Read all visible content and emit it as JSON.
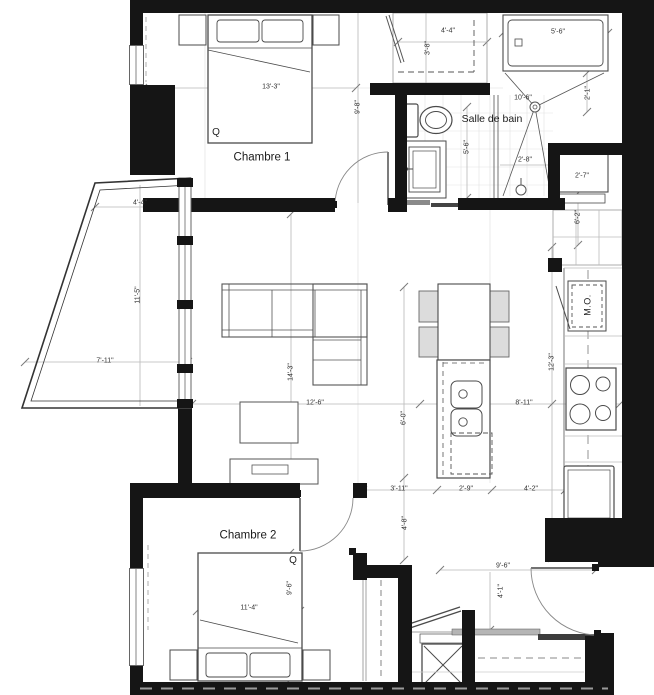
{
  "colors": {
    "wall": "#151515",
    "background": "#ffffff",
    "furniture_line": "#4a4a4a",
    "dimension_line": "#b8b8b8",
    "text": "#222222"
  },
  "rooms": {
    "chambre1": "Chambre 1",
    "chambre2": "Chambre 2",
    "bathroom": "Salle de bain"
  },
  "fixtures": {
    "microwave": "M.O.",
    "bed1_size": "Q",
    "bed2_size": "Q"
  },
  "dims": {
    "closet1_w": "4'-4\"",
    "closet1_d": "3'-8\"",
    "tub_w": "5'-6\"",
    "ch1_w": "13'-3\"",
    "ch1_h": "9'-8\"",
    "shower_diag": "10'-6\"",
    "shower_side": "2'-1\"",
    "bath_h": "5'-6\"",
    "shower_w": "2'-8\"",
    "laundry_w": "2'-7\"",
    "laundry_h": "6'-2\"",
    "balcony_top": "4'-4\"",
    "balcony_h": "11'-5\"",
    "balcony_bottom": "7'-11\"",
    "living_h": "14'-3\"",
    "living_w": "12'-6\"",
    "island_side": "6'-0\"",
    "kitchen_h": "12'-3\"",
    "kitchen_w": "8'-11\"",
    "hall_w": "3'-11\"",
    "island_w": "2'-9\"",
    "kitchen_aisle": "4'-2\"",
    "hall_h": "4'-8\"",
    "ch2_h": "9'-6\"",
    "ch2_w": "11'-4\"",
    "entry_w": "9'-6\"",
    "entry_h": "4'-1\""
  }
}
